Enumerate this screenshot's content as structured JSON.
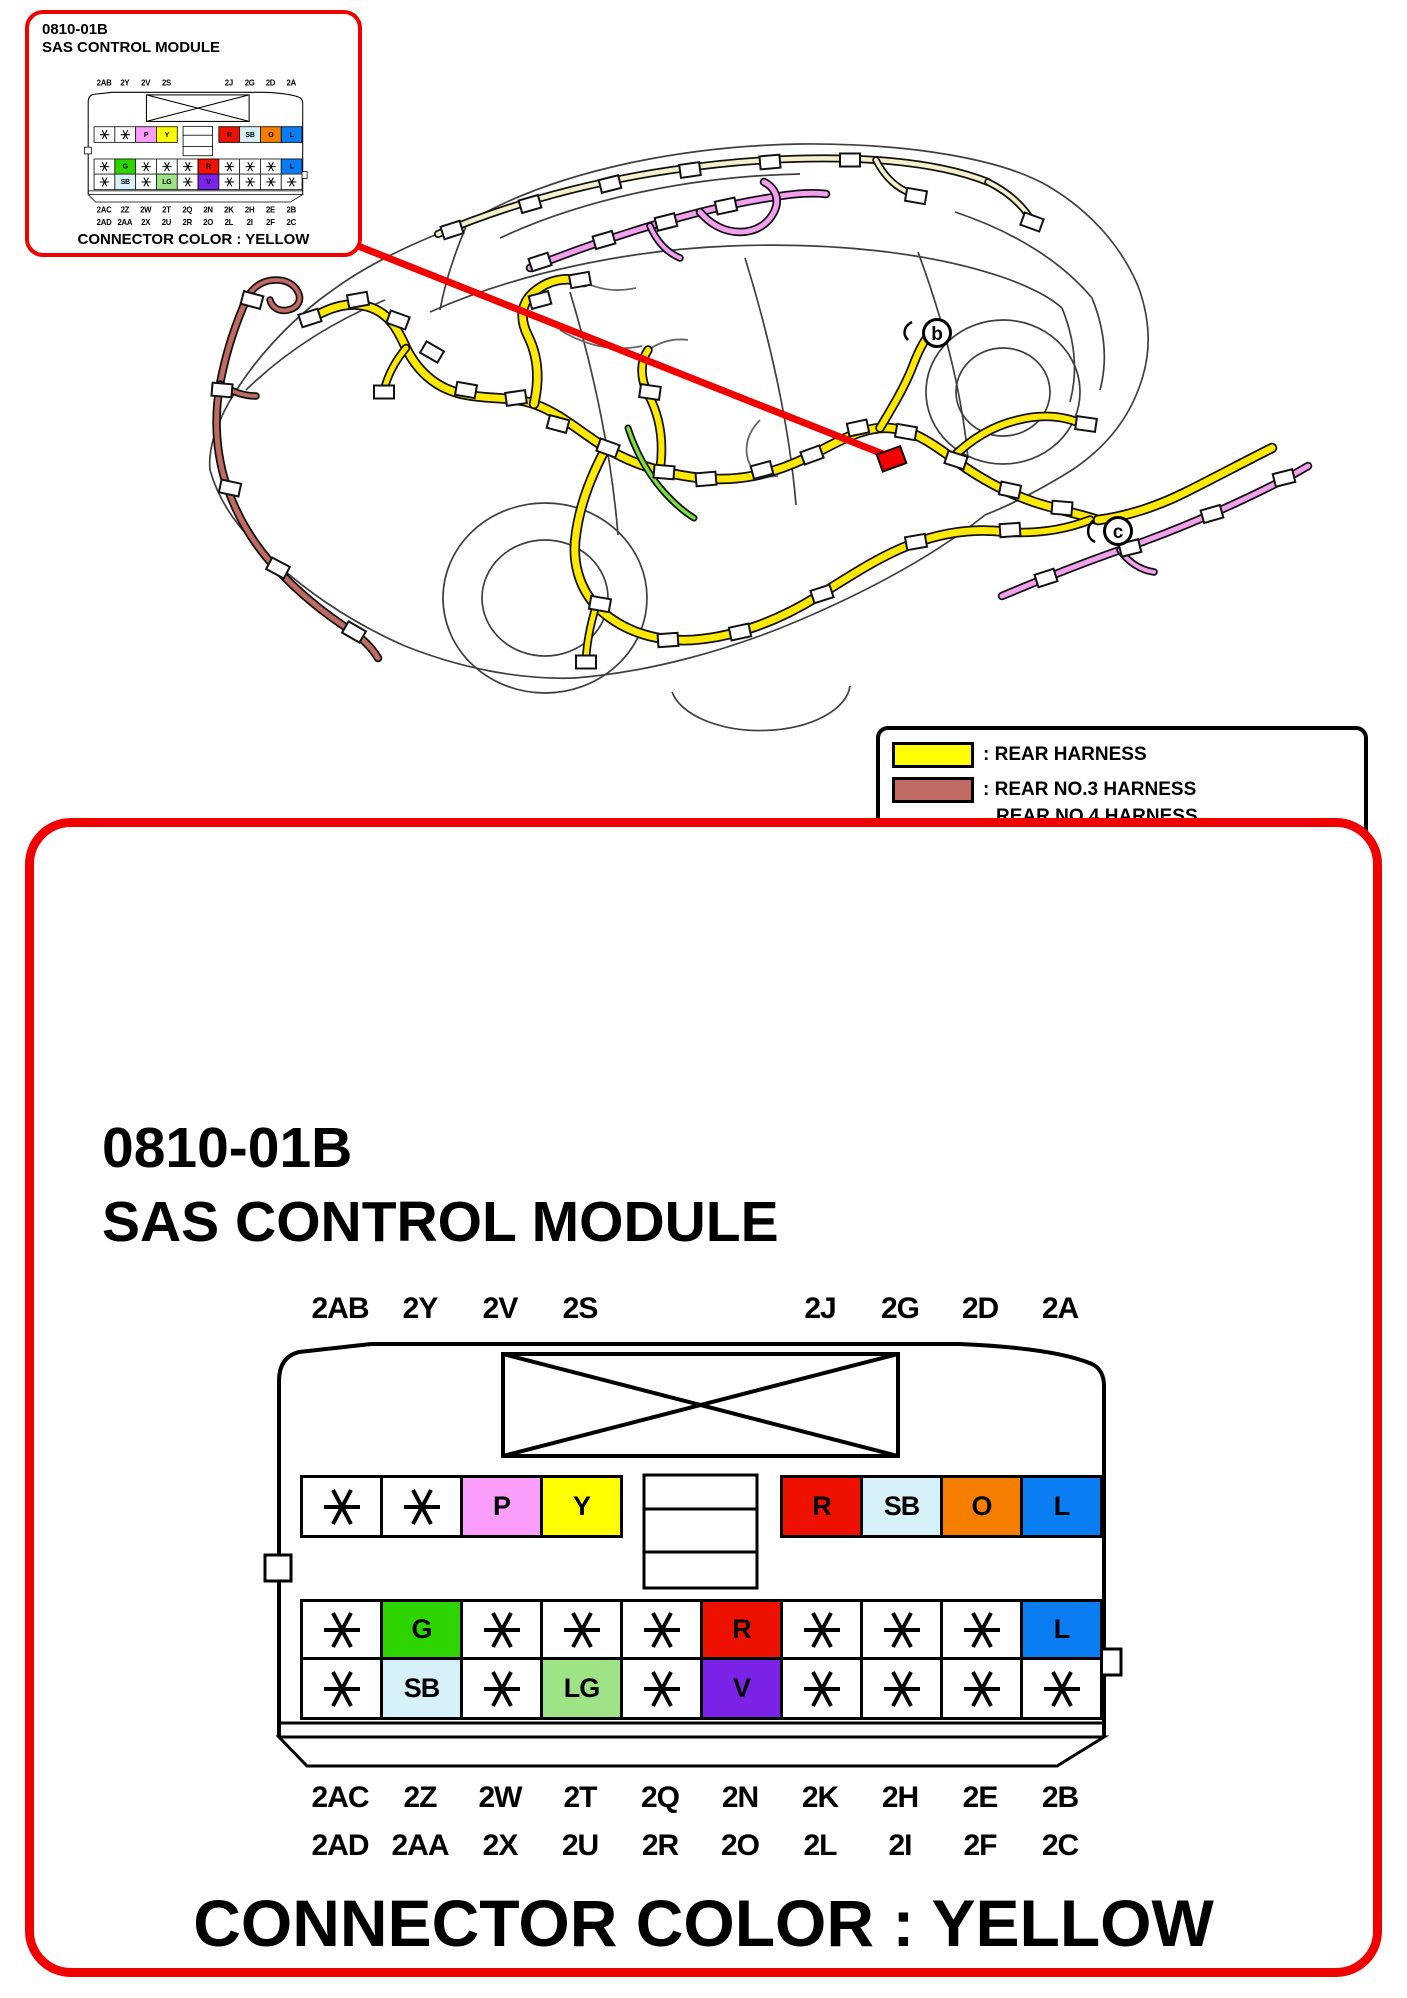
{
  "mini_box": {
    "title_line1": "0810-01B",
    "title_line2": "SAS CONTROL MODULE",
    "footer": "CONNECTOR COLOR : YELLOW"
  },
  "main_box": {
    "title_line1": "0810-01B",
    "title_line2": "SAS CONTROL MODULE",
    "footer": "CONNECTOR COLOR : YELLOW"
  },
  "connector": {
    "top_labels": [
      "2AB",
      "2Y",
      "2V",
      "2S",
      "2J",
      "2G",
      "2D",
      "2A"
    ],
    "bottom_labels_row1": [
      "2AC",
      "2Z",
      "2W",
      "2T",
      "2Q",
      "2N",
      "2K",
      "2H",
      "2E",
      "2B"
    ],
    "bottom_labels_row2": [
      "2AD",
      "2AA",
      "2X",
      "2U",
      "2R",
      "2O",
      "2L",
      "2I",
      "2F",
      "2C"
    ],
    "row1_left": [
      "*",
      "*",
      "P",
      "Y"
    ],
    "row1_right": [
      "R",
      "SB",
      "O",
      "L"
    ],
    "row2": [
      "*",
      "G",
      "*",
      "*",
      "*",
      "R",
      "*",
      "*",
      "*",
      "L"
    ],
    "row3": [
      "*",
      "SB",
      "*",
      "LG",
      "*",
      "V",
      "*",
      "*",
      "*",
      "*"
    ],
    "pin_colors": {
      "P": "#FB9EFB",
      "Y": "#FFFF00",
      "R": "#EE1000",
      "SB": "#D6F2F8",
      "O": "#F57E00",
      "L": "#0A7DF2",
      "G": "#2ED400",
      "LG": "#9FE387",
      "V": "#7A22E6"
    },
    "default_pin_color": "#FFFFFF"
  },
  "legend": {
    "items": [
      {
        "color": "#FFFF00",
        "lines": [
          ": REAR HARNESS"
        ]
      },
      {
        "color": "#BF6A62",
        "lines": [
          ": REAR NO.3 HARNESS",
          "REAR NO.4 HARNESS"
        ]
      },
      {
        "color": "#F79CF2",
        "lines": [
          ": DOOR HARNESS"
        ]
      },
      {
        "color": "#FAF8D8",
        "lines": [
          ": INTERIOR LIGHT HARNESS",
          "INTERIOR LIGHT NO.2 HARNESS"
        ]
      },
      {
        "color": "#9FE32B",
        "lines": [
          ": FLOOR HARNESS"
        ]
      }
    ]
  },
  "car_diagram": {
    "callout_b": "b",
    "callout_c": "c",
    "colors": {
      "rear": "#FFE900",
      "rear_no34": "#BF6A62",
      "door": "#F2A0EE",
      "interior_light": "#F5F0CC",
      "floor": "#7FDC3C",
      "callout": "#F10000",
      "outline": "#3F3F3F"
    }
  }
}
